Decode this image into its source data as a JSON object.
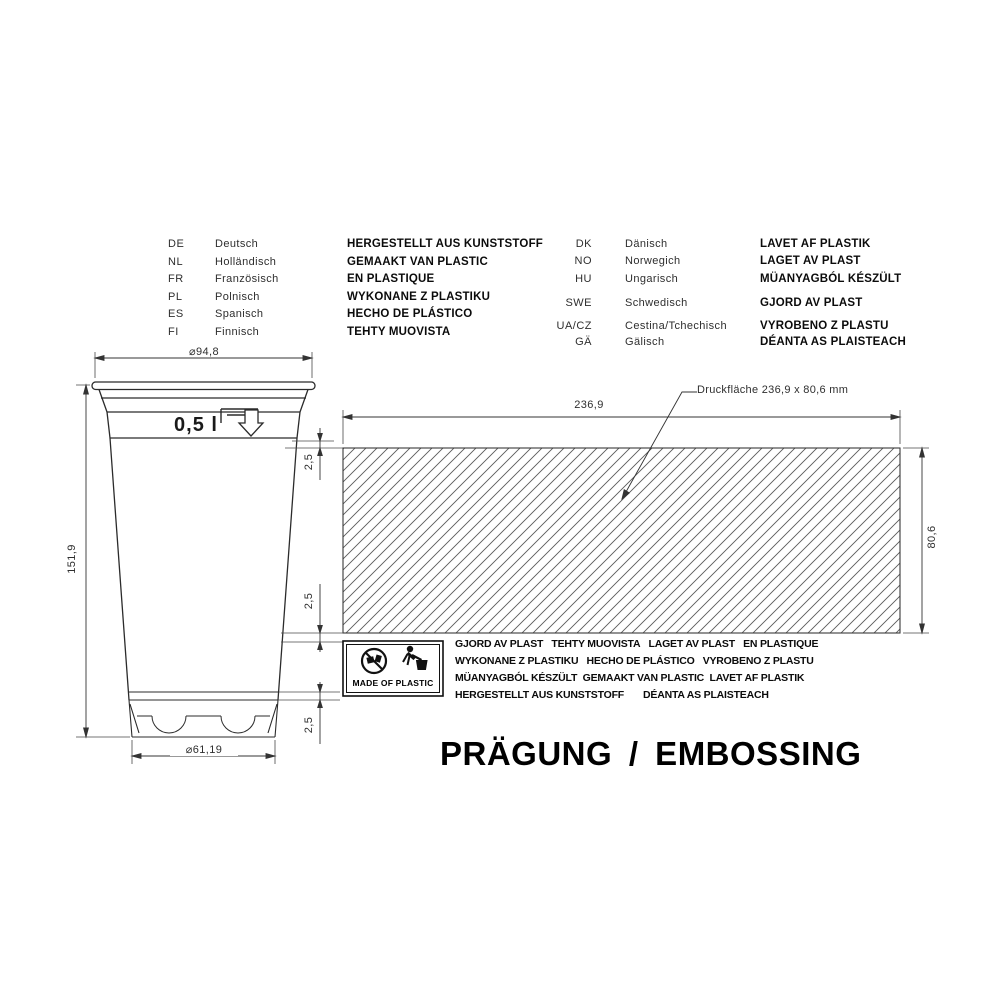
{
  "colors": {
    "line": "#333333",
    "text": "#111111",
    "background": "#ffffff"
  },
  "title": "PRÄGUNG / EMBOSSING",
  "language_table": {
    "left": {
      "rows": [
        {
          "code": "DE",
          "name": "Deutsch",
          "phrase": "HERGESTELLT AUS KUNSTSTOFF"
        },
        {
          "code": "NL",
          "name": "Holländisch",
          "phrase": "GEMAAKT VAN PLASTIC"
        },
        {
          "code": "FR",
          "name": "Französisch",
          "phrase": "EN PLASTIQUE"
        },
        {
          "code": "PL",
          "name": "Polnisch",
          "phrase": "WYKONANE Z PLASTIKU"
        },
        {
          "code": "ES",
          "name": "Spanisch",
          "phrase": "HECHO DE PLÁSTICO"
        },
        {
          "code": "FI",
          "name": "Finnisch",
          "phrase": "TEHTY MUOVISTA"
        }
      ]
    },
    "right": {
      "rows": [
        {
          "code": "DK",
          "name": "Dänisch",
          "phrase": "LAVET AF PLASTIK"
        },
        {
          "code": "NO",
          "name": "Norwegich",
          "phrase": "LAGET AV PLAST"
        },
        {
          "code": "HU",
          "name": "Ungarisch",
          "phrase": "MÜANYAGBÓL KÉSZÜLT"
        },
        {
          "code": "SWE",
          "name": "Schwedisch",
          "phrase": "GJORD AV PLAST"
        },
        {
          "code": "UA/CZ",
          "name": "Cestina/Tchechisch",
          "phrase": "VYROBENO Z PLASTU"
        },
        {
          "code": "GÄ",
          "name": "Gälisch",
          "phrase": "DÉANTA AS PLAISTEACH"
        }
      ]
    }
  },
  "drawing": {
    "volume_label": "0,5 l",
    "print_area_label": "Druckfläche 236,9 x 80,6 mm",
    "dims": {
      "top_diameter": "⌀94,8",
      "height": "151,9",
      "bottom_diameter": "⌀61,19",
      "print_width": "236,9",
      "print_height": "80,6",
      "offset_top": "2,5",
      "offset_mid": "2,5",
      "offset_bottom": "2,5"
    }
  },
  "embossing": {
    "badge_text": "MADE OF PLASTIC",
    "icons": [
      "prohibition-sign-icon",
      "tidyman-icon"
    ],
    "lines": [
      "GJORD AV PLAST   TEHTY MUOVISTA   LAGET AV PLAST   EN PLASTIQUE",
      "WYKONANE Z PLASTIKU   HECHO DE PLÁSTICO   VYROBENO Z PLASTU",
      "MÜANYAGBÓL KÉSZÜLT  GEMAAKT VAN PLASTIC  LAVET AF PLASTIK",
      "HERGESTELLT AUS KUNSTSTOFF       DÉANTA AS PLAISTEACH"
    ]
  }
}
